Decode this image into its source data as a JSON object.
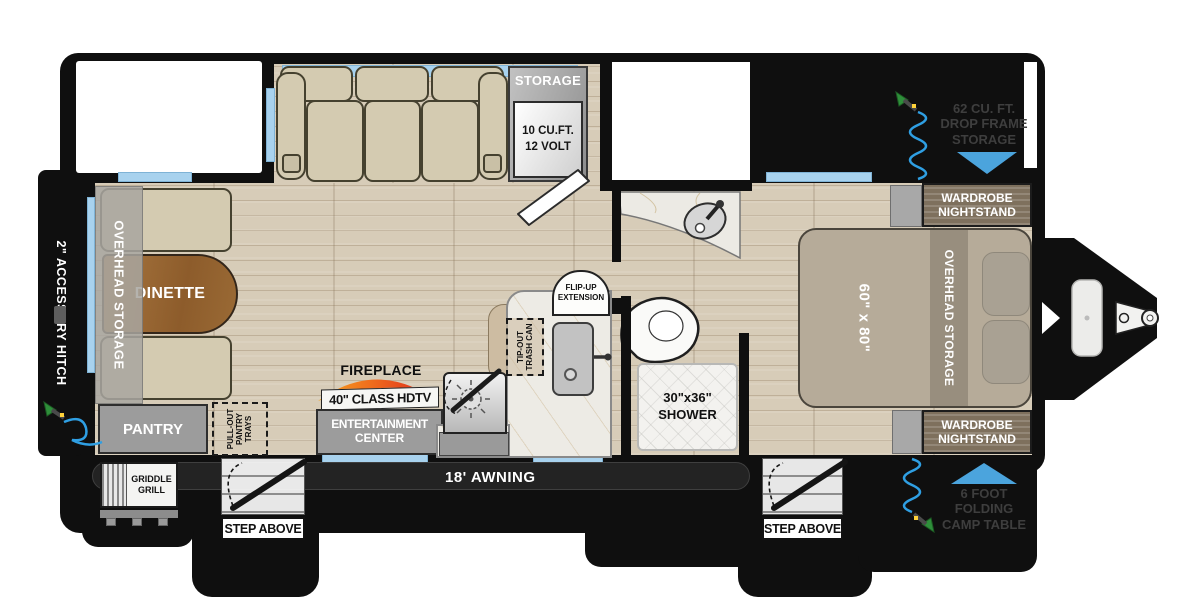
{
  "title": "Travel Trailer Floorplan",
  "colors": {
    "outline_black": "#0f0f0f",
    "window_blue": "#a8d2ee",
    "arrow_blue": "#4ba4dd",
    "hose_blue": "#2f9fe3",
    "nozzle_green": "#2e8f3a",
    "flame_orange": "#f7a41f",
    "flame_red": "#de221c",
    "floor_wood": "#d7ccb8"
  },
  "exterior": {
    "accessory_hitch": "2\" ACCESSORY HITCH",
    "drop_frame_storage": [
      "62 CU. FT.",
      "DROP FRAME",
      "STORAGE"
    ],
    "folding_camp_table": [
      "6 FOOT",
      "FOLDING",
      "CAMP TABLE"
    ],
    "awning": "18' AWNING",
    "griddle_grill": [
      "GRIDDLE",
      "GRILL"
    ],
    "step_above": "STEP ABOVE"
  },
  "living_area": {
    "overhead_storage": "OVERHEAD STORAGE",
    "dinette": "DINETTE",
    "pantry": "PANTRY",
    "pullout_pantry_trays": [
      "PULL-OUT",
      "PANTRY",
      "TRAYS"
    ],
    "fireplace": "FIREPLACE",
    "tv": "40\" CLASS HDTV",
    "entertainment_center": [
      "ENTERTAINMENT",
      "CENTER"
    ],
    "storage_cabinet": "STORAGE",
    "refrigerator": [
      "10 CU.FT.",
      "12 VOLT"
    ]
  },
  "kitchen": {
    "flip_up_extension": [
      "FLIP-UP",
      "EXTENSION"
    ],
    "tip_out_trash": [
      "TIP-OUT",
      "TRASH CAN"
    ]
  },
  "bathroom": {
    "shower": [
      "30\"x36\"",
      "SHOWER"
    ]
  },
  "bedroom": {
    "bed_size": "60\" x 80\"",
    "overhead_storage": "OVERHEAD STORAGE",
    "wardrobe_nightstand": [
      "WARDROBE",
      "NIGHTSTAND"
    ]
  }
}
